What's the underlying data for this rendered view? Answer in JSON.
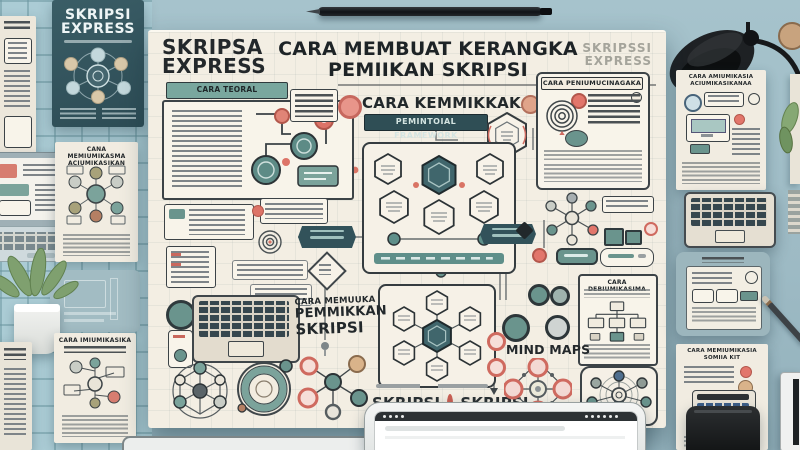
{
  "colors": {
    "wall": "#9fbcc6",
    "wall_grid": "#abccd5",
    "board": "#f3eee3",
    "panel": "#f8f4ea",
    "dark_teal": "#31535c",
    "teal": "#6a948d",
    "teal_banner": "#79a79e",
    "coral": "#df7468",
    "ink": "#24292c",
    "bar_grey": "#8d9295"
  },
  "board": {
    "logo": {
      "line1": "SKRIPSA",
      "line2": "EXPRESS"
    },
    "title": {
      "line1": "CARA MEMBUAT KERANGKA",
      "line2": "PEMIIKAN SKRIPSI"
    },
    "watermark": {
      "line1": "SKRIPSSI",
      "line2": "EXPRESS"
    },
    "left_section": {
      "banner": "CARA TEORAL FRAMEWORK"
    },
    "center_section": {
      "heading": "CARA KEMMIKKAKA",
      "banner": "PEMINTOIAL FRAMEWORK"
    },
    "bottom_center": {
      "line1": "CARA MEMUUKA",
      "line2": "PEMMIKKAN",
      "line3": "SKRIPSI",
      "skripsi_left": "SKRIPSI",
      "skripsi_right": "SKRIPSI"
    },
    "right_section": {
      "panel_title": "CARA PENIUMUCINAGAKA",
      "tree_panel_title": "CARA DEBIUMIKASIMA",
      "mind_maps_label": "MIND MAPS"
    }
  },
  "surroundings": {
    "book": {
      "title_line1": "SKRIPSI",
      "title_line2": "EXPRESS"
    },
    "paper_left_mid": {
      "title_line1": "CANA MEMIUMIKASMA",
      "title_line2": "ACIUMIKASIKAN"
    },
    "paper_left_bottom": {
      "title": "CARA IMIUMIKASIKA"
    },
    "paper_right_top": {
      "title_line1": "CARA AMIUMIKASIA",
      "title_line2": "ACIUMIKASIKANAA"
    },
    "paper_right_bottom": {
      "title_line1": "CARA MEMIUMIKASIA",
      "title_line2": "SOMIIA KIT"
    }
  }
}
